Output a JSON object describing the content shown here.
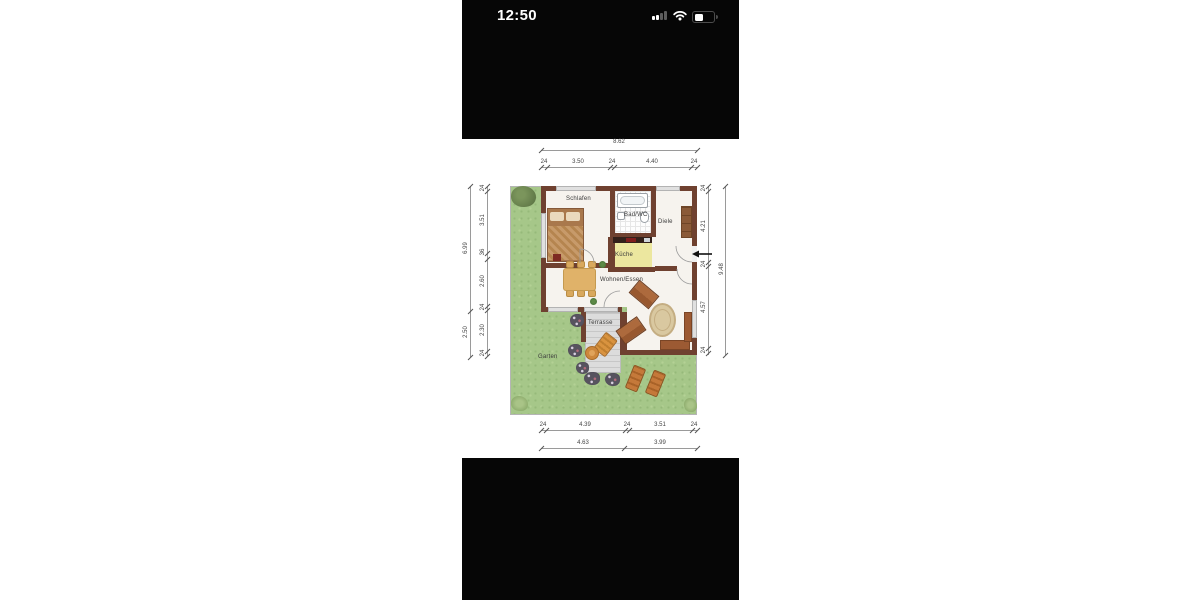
{
  "status_bar": {
    "time": "12:50",
    "icons": [
      "cellular-signal-icon",
      "wifi-icon",
      "battery-icon"
    ],
    "battery_fill_percent": 42,
    "signal_bars_lit": 2
  },
  "floor_plan": {
    "room_labels": {
      "schlafen": "Schlafen",
      "bad_wc": "Bad/WC",
      "diele": "Diele",
      "kueche": "Küche",
      "wohnen_essen": "Wohnen/Essen",
      "terrasse": "Terrasse",
      "garten": "Garten"
    },
    "dimensions": {
      "top": {
        "total": "8.62",
        "chain": [
          "24",
          "3.50",
          "24",
          "4.40",
          "24"
        ]
      },
      "bottom": {
        "chain": [
          "24",
          "4.39",
          "24",
          "3.51",
          "24"
        ],
        "totals": [
          "4.63",
          "3.99"
        ]
      },
      "left": {
        "chain": [
          "24",
          "3.51",
          "36",
          "2.60",
          "24",
          "2.30",
          "24"
        ],
        "totals": [
          "6.99",
          "2.50"
        ]
      },
      "right": {
        "chain": [
          "24",
          "4.21",
          "24",
          "4.57",
          "24"
        ],
        "total": "9.48"
      }
    },
    "icons": [
      "entrance-arrow-icon"
    ],
    "colors": {
      "grass": "#a6c789",
      "wall": "#6f4130",
      "terrace_deck": "#dcdcdc",
      "kitchen_floor": "#ece79f",
      "furniture_wood": "#a97848",
      "status_bar_bg": "#060606",
      "dimension_text": "#444444"
    }
  }
}
